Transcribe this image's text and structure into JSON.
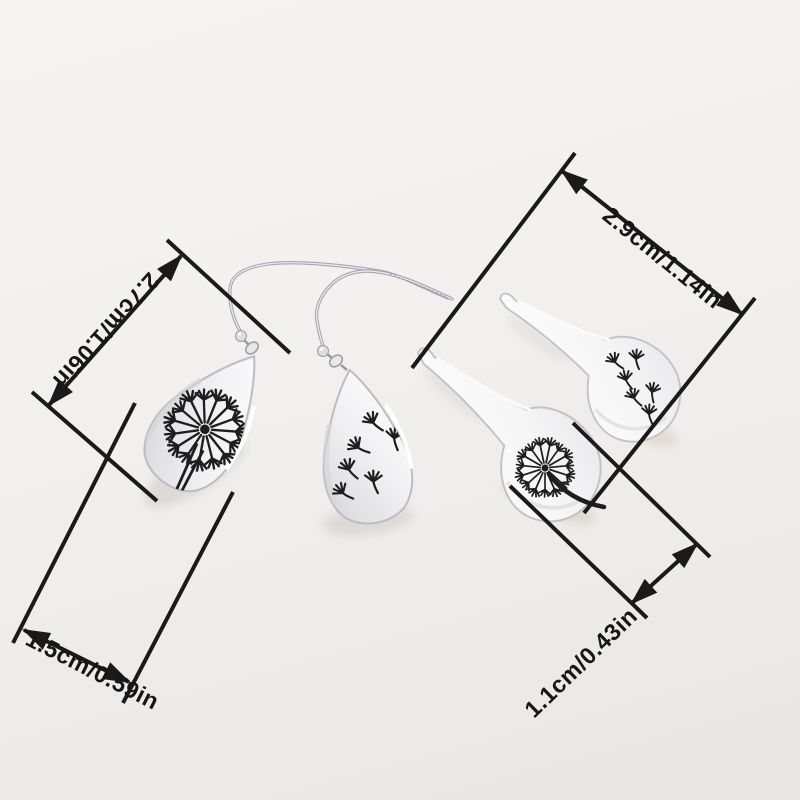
{
  "scene": {
    "subject": "silver dandelion teardrop earrings set product photo",
    "background_top": "#f6f4f3",
    "background_bottom": "#e9e7e5",
    "line_color": "#1a1a1a",
    "text_color": "#161616",
    "metal_light": "#ffffff",
    "metal_dark": "#c7c7cd",
    "engraving_color": "#1e1e1e",
    "warm_shadow": "#d5cabb"
  },
  "annotations": {
    "top_right": {
      "label": "2.9cm/1.14in"
    },
    "left": {
      "label": "2.7cm/1.06in"
    },
    "bottom_left": {
      "label": "1.5cm/0.59in"
    },
    "bottom_right": {
      "label": "1.1cm/0.43in"
    }
  }
}
